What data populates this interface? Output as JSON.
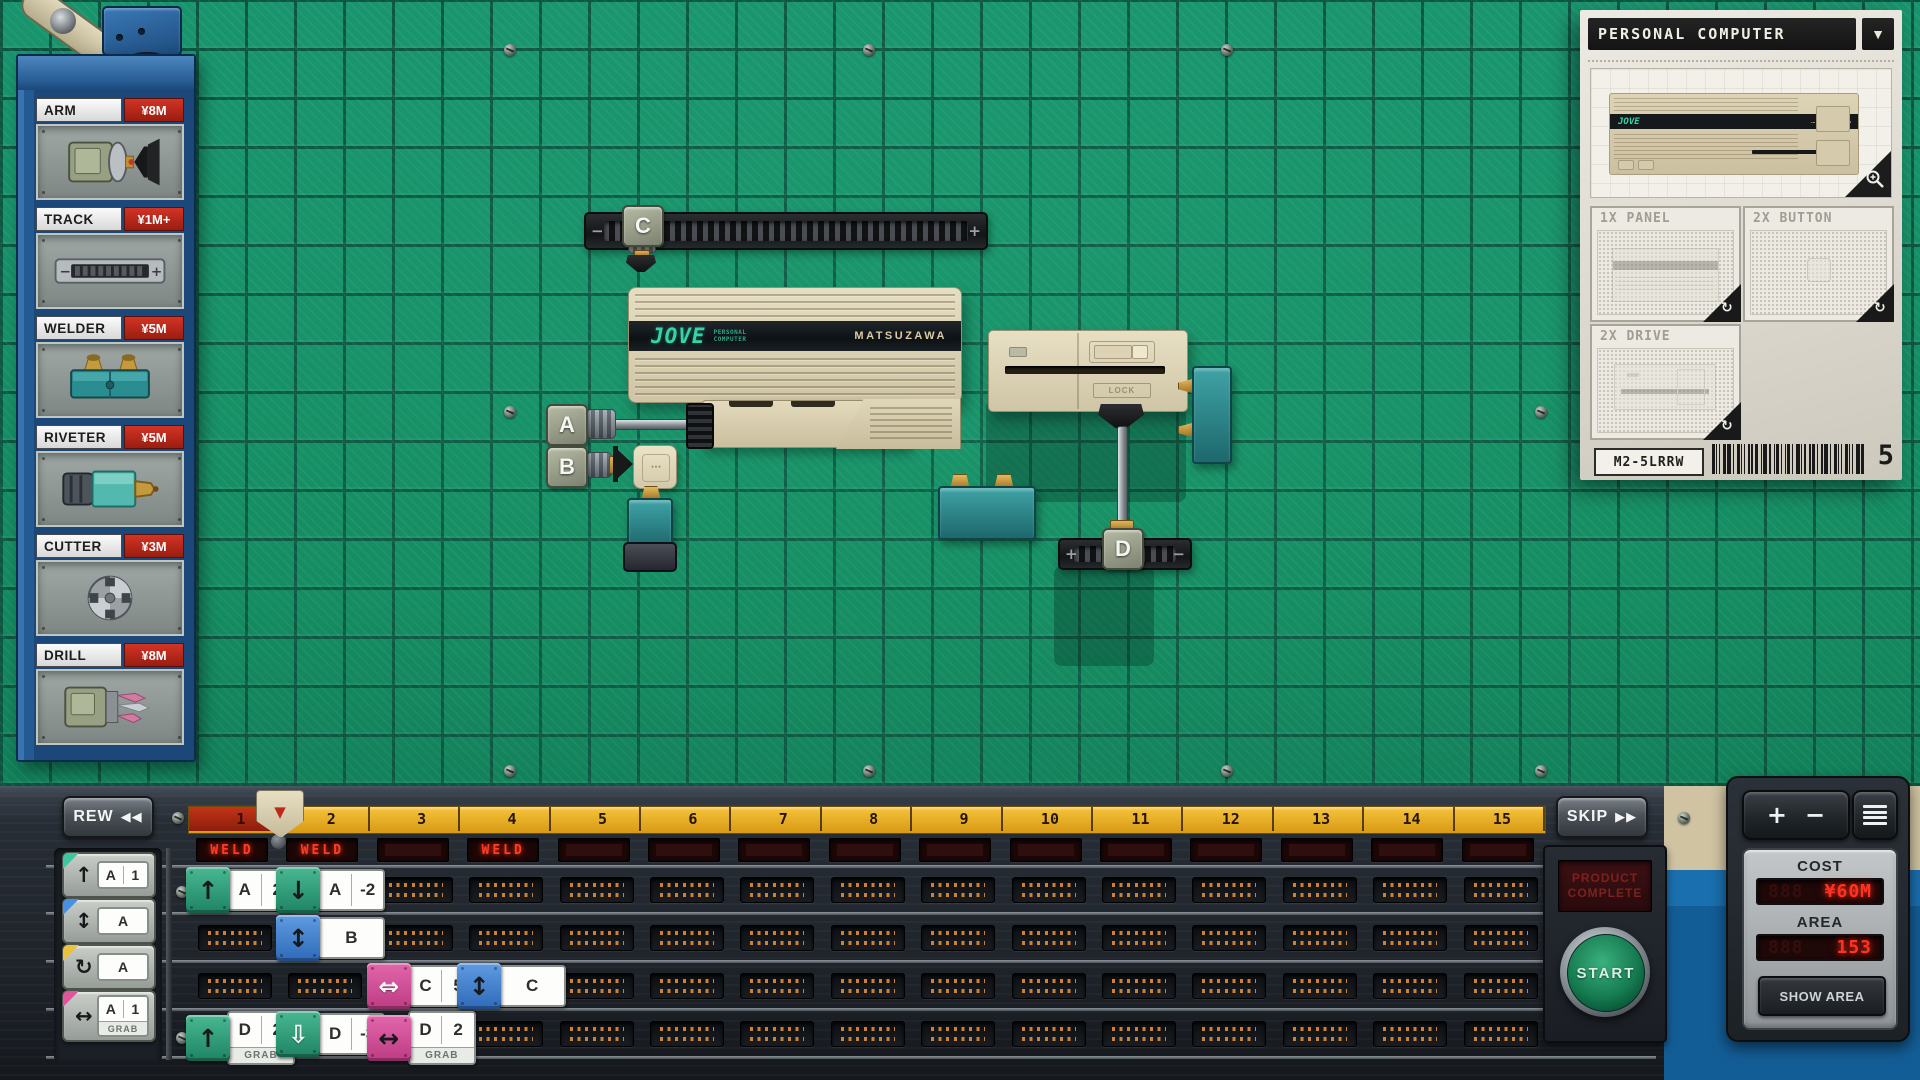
{
  "shop": {
    "items": [
      {
        "label": "ARM",
        "price": "¥8M",
        "icon": "arm"
      },
      {
        "label": "TRACK",
        "price": "¥1M+",
        "icon": "track"
      },
      {
        "label": "WELDER",
        "price": "¥5M",
        "icon": "welder"
      },
      {
        "label": "RIVETER",
        "price": "¥5M",
        "icon": "riveter"
      },
      {
        "label": "CUTTER",
        "price": "¥3M",
        "icon": "cutter"
      },
      {
        "label": "DRILL",
        "price": "¥8M",
        "icon": "drill"
      }
    ]
  },
  "blueprint": {
    "title": "PERSONAL COMPUTER",
    "dropdown_icon": "▼",
    "product": {
      "brand": "JOVE",
      "maker": "MATSUZAWA"
    },
    "subparts": [
      {
        "label": "1X PANEL"
      },
      {
        "label": "2X BUTTON"
      },
      {
        "label": "2X DRIVE"
      }
    ],
    "rotate_icon": "↻",
    "model_code": "M2-5LRRW",
    "quantity": "5"
  },
  "floor": {
    "machines": {
      "a": "A",
      "b": "B",
      "c": "C",
      "d": "D"
    },
    "chassis": {
      "brand": "JOVE",
      "brand_sub_1": "PERSONAL",
      "brand_sub_2": "COMPUTER",
      "maker": "MATSUZAWA"
    },
    "drive": {
      "lock_label": "LOCK"
    },
    "rail": {
      "minus": "−",
      "plus": "+"
    },
    "d_track": {
      "plus": "+",
      "minus": "−"
    }
  },
  "sequencer": {
    "rew_label": "REW",
    "rew_icon": "◀◀",
    "skip_label": "SKIP",
    "skip_icon": "▶▶",
    "ruler": {
      "segments": [
        "1",
        "2",
        "3",
        "4",
        "5",
        "6",
        "7",
        "8",
        "9",
        "10",
        "11",
        "12",
        "13",
        "14",
        "15"
      ],
      "current": 1,
      "playhead_icon": "▼"
    },
    "led_cells": [
      "WELD",
      "WELD",
      "",
      "WELD",
      "",
      "",
      "",
      "",
      "",
      "",
      "",
      "",
      "",
      "",
      ""
    ],
    "palette": [
      {
        "arrow": "↑",
        "color": "teal",
        "letter": "A",
        "value": "1",
        "grab": false
      },
      {
        "arrow": "↕",
        "color": "blue",
        "letter": "A",
        "value": "",
        "grab": false
      },
      {
        "arrow": "↻",
        "color": "yellow",
        "letter": "A",
        "value": "",
        "grab": false
      },
      {
        "arrow": "↔",
        "color": "pink",
        "letter": "A",
        "value": "1",
        "grab": true
      }
    ],
    "grab_label": "GRAB",
    "program": [
      {
        "row": 0,
        "col": 0,
        "color": "teal",
        "arrow": "↑",
        "outline": false,
        "letter": "A",
        "value": "2",
        "grab": false
      },
      {
        "row": 0,
        "col": 1,
        "color": "teal",
        "arrow": "↓",
        "outline": false,
        "letter": "A",
        "value": "-2",
        "grab": false
      },
      {
        "row": 1,
        "col": 1,
        "color": "blue",
        "arrow": "↕",
        "outline": false,
        "letter": "B",
        "value": "",
        "grab": false
      },
      {
        "row": 2,
        "col": 2,
        "color": "pink",
        "arrow": "⇔",
        "outline": true,
        "letter": "C",
        "value": "5",
        "grab": false
      },
      {
        "row": 2,
        "col": 3,
        "color": "blue",
        "arrow": "↕",
        "outline": false,
        "letter": "C",
        "value": "",
        "grab": false
      },
      {
        "row": 3,
        "col": 0,
        "color": "teal",
        "arrow": "↑",
        "outline": false,
        "letter": "D",
        "value": "2",
        "grab": true
      },
      {
        "row": 3,
        "col": 1,
        "color": "teal",
        "arrow": "⇩",
        "outline": true,
        "letter": "D",
        "value": "-3",
        "grab": false
      },
      {
        "row": 3,
        "col": 2,
        "color": "pink",
        "arrow": "↔",
        "outline": false,
        "letter": "D",
        "value": "2",
        "grab": true
      }
    ],
    "start": {
      "label": "START",
      "display_line1": "PRODUCT",
      "display_line2": "COMPLETE"
    },
    "meters": {
      "cost_label": "COST",
      "cost_value": "¥60M",
      "area_label": "AREA",
      "area_value": "153",
      "show_area_label": "SHOW AREA"
    },
    "zoom_plus": "+",
    "zoom_minus": "−"
  }
}
